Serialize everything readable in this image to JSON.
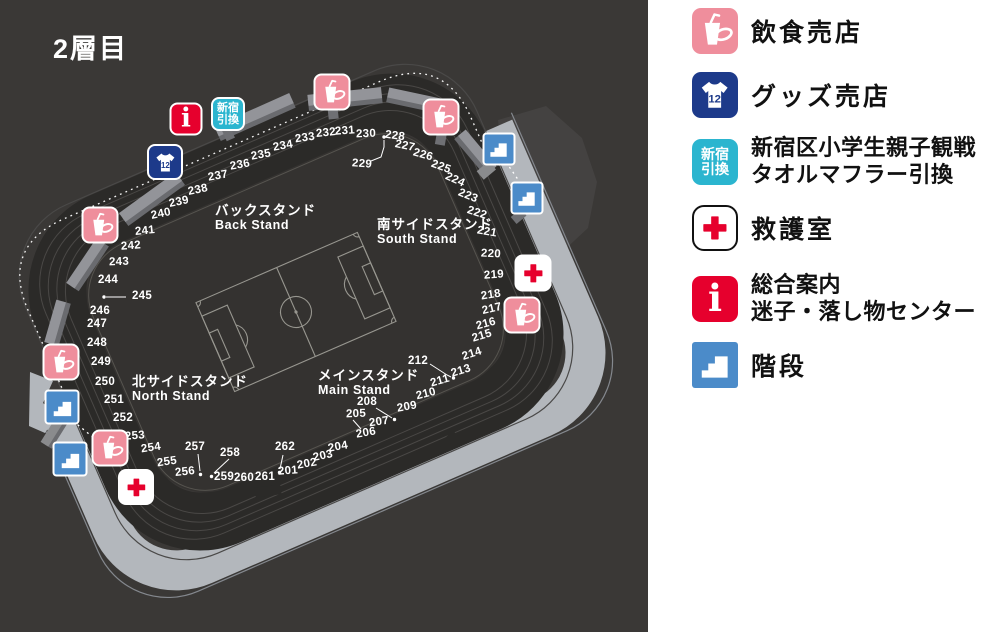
{
  "title": "2層目",
  "colors": {
    "map_bg": "#3a3836",
    "stands_band": "#2b2a28",
    "bowl": "#343230",
    "concourse": "#b3b7bc",
    "upper_tier": "#444241",
    "slab_top": "#939499",
    "slab_side": "#6a6b6f",
    "pitch_line": "#97968f",
    "food": "#ef8e9c",
    "goods": "#1d3a8a",
    "shinjuku": "#2bb5cf",
    "info_red": "#e6002d",
    "cross_red": "#e6002d",
    "stairs_blue": "#4b8bc9",
    "firstaid_bg": "#ffffff",
    "legend_text": "#111111"
  },
  "icon_text": {
    "goods_number": "12",
    "info_letter": "i",
    "shinjuku_line1": "新宿",
    "shinjuku_line2": "引換"
  },
  "stands": [
    {
      "jp": "バックスタンド",
      "en": "Back Stand",
      "x": 215,
      "y": 203
    },
    {
      "jp": "南サイドスタンド",
      "en": "South Stand",
      "x": 377,
      "y": 217
    },
    {
      "jp": "北サイドスタンド",
      "en": "North Stand",
      "x": 132,
      "y": 374
    },
    {
      "jp": "メインスタンド",
      "en": "Main Stand",
      "x": 318,
      "y": 368
    }
  ],
  "sections": [
    [
      201,
      288,
      471,
      -4
    ],
    [
      202,
      307,
      464,
      -10
    ],
    [
      203,
      323,
      456,
      -12
    ],
    [
      204,
      338,
      447,
      -10
    ],
    [
      205,
      356,
      414,
      -2
    ],
    [
      206,
      366,
      433,
      -10
    ],
    [
      207,
      379,
      422,
      -8
    ],
    [
      208,
      367,
      402,
      0
    ],
    [
      209,
      407,
      407,
      -10
    ],
    [
      210,
      426,
      394,
      -14
    ],
    [
      211,
      440,
      381,
      -16
    ],
    [
      212,
      418,
      361,
      0
    ],
    [
      213,
      461,
      371,
      -17
    ],
    [
      214,
      472,
      354,
      -18
    ],
    [
      215,
      482,
      336,
      -17
    ],
    [
      216,
      486,
      324,
      -15
    ],
    [
      217,
      492,
      309,
      -13
    ],
    [
      218,
      491,
      295,
      -9
    ],
    [
      219,
      494,
      275,
      -4
    ],
    [
      220,
      491,
      254,
      3
    ],
    [
      221,
      487,
      232,
      10
    ],
    [
      222,
      477,
      213,
      18
    ],
    [
      223,
      468,
      196,
      22
    ],
    [
      224,
      455,
      180,
      24
    ],
    [
      225,
      441,
      167,
      20
    ],
    [
      226,
      423,
      155,
      16
    ],
    [
      227,
      405,
      146,
      12
    ],
    [
      228,
      395,
      136,
      8
    ],
    [
      229,
      362,
      164,
      4
    ],
    [
      230,
      366,
      134,
      -2
    ],
    [
      231,
      345,
      131,
      -4
    ],
    [
      232,
      326,
      133,
      -6
    ],
    [
      233,
      305,
      138,
      -8
    ],
    [
      234,
      283,
      146,
      -10
    ],
    [
      235,
      261,
      155,
      -10
    ],
    [
      236,
      240,
      165,
      -10
    ],
    [
      237,
      218,
      176,
      -10
    ],
    [
      238,
      198,
      190,
      -12
    ],
    [
      239,
      179,
      202,
      -12
    ],
    [
      240,
      161,
      214,
      -12
    ],
    [
      241,
      145,
      231,
      -6
    ],
    [
      242,
      131,
      246,
      -4
    ],
    [
      243,
      119,
      262,
      -2
    ],
    [
      244,
      108,
      280,
      0
    ],
    [
      245,
      142,
      296,
      0
    ],
    [
      246,
      100,
      311,
      0
    ],
    [
      247,
      97,
      324,
      0
    ],
    [
      248,
      97,
      343,
      0
    ],
    [
      249,
      101,
      362,
      0
    ],
    [
      250,
      105,
      382,
      0
    ],
    [
      251,
      114,
      400,
      0
    ],
    [
      252,
      123,
      418,
      0
    ],
    [
      253,
      135,
      436,
      -4
    ],
    [
      254,
      151,
      448,
      -8
    ],
    [
      255,
      167,
      462,
      -8
    ],
    [
      256,
      185,
      472,
      -6
    ],
    [
      257,
      195,
      447,
      0
    ],
    [
      258,
      230,
      453,
      0
    ],
    [
      259,
      224,
      477,
      0
    ],
    [
      260,
      244,
      478,
      0
    ],
    [
      261,
      265,
      477,
      0
    ],
    [
      262,
      285,
      447,
      0
    ]
  ],
  "map_icons": [
    {
      "type": "food",
      "x": 332,
      "y": 92,
      "s": 37
    },
    {
      "type": "food",
      "x": 441,
      "y": 117,
      "s": 37
    },
    {
      "type": "stairs",
      "x": 499,
      "y": 149,
      "s": 33
    },
    {
      "type": "stairs",
      "x": 527,
      "y": 198,
      "s": 33
    },
    {
      "type": "firstaid",
      "x": 533,
      "y": 273,
      "s": 37
    },
    {
      "type": "food",
      "x": 522,
      "y": 315,
      "s": 37
    },
    {
      "type": "food",
      "x": 100,
      "y": 225,
      "s": 37
    },
    {
      "type": "food",
      "x": 61,
      "y": 362,
      "s": 37
    },
    {
      "type": "stairs",
      "x": 62,
      "y": 407,
      "s": 35
    },
    {
      "type": "stairs",
      "x": 70,
      "y": 459,
      "s": 35
    },
    {
      "type": "food",
      "x": 110,
      "y": 448,
      "s": 37
    },
    {
      "type": "firstaid",
      "x": 136,
      "y": 487,
      "s": 36
    },
    {
      "type": "info",
      "x": 186,
      "y": 119,
      "s": 33
    },
    {
      "type": "shinjuku",
      "x": 228,
      "y": 114,
      "s": 34
    },
    {
      "type": "goods",
      "x": 165,
      "y": 162,
      "s": 36
    }
  ],
  "legend": {
    "items": [
      {
        "icon": "food",
        "lines": [
          "飲食売店"
        ]
      },
      {
        "icon": "goods",
        "lines": [
          "グッズ売店"
        ]
      },
      {
        "icon": "shinjuku",
        "lines": [
          "新宿区小学生親子観戦",
          "タオルマフラー引換"
        ]
      },
      {
        "icon": "firstaid",
        "lines": [
          "救護室"
        ]
      },
      {
        "icon": "info",
        "lines": [
          "総合案内",
          "迷子・落し物センター"
        ]
      },
      {
        "icon": "stairs",
        "lines": [
          "階段"
        ]
      }
    ]
  }
}
